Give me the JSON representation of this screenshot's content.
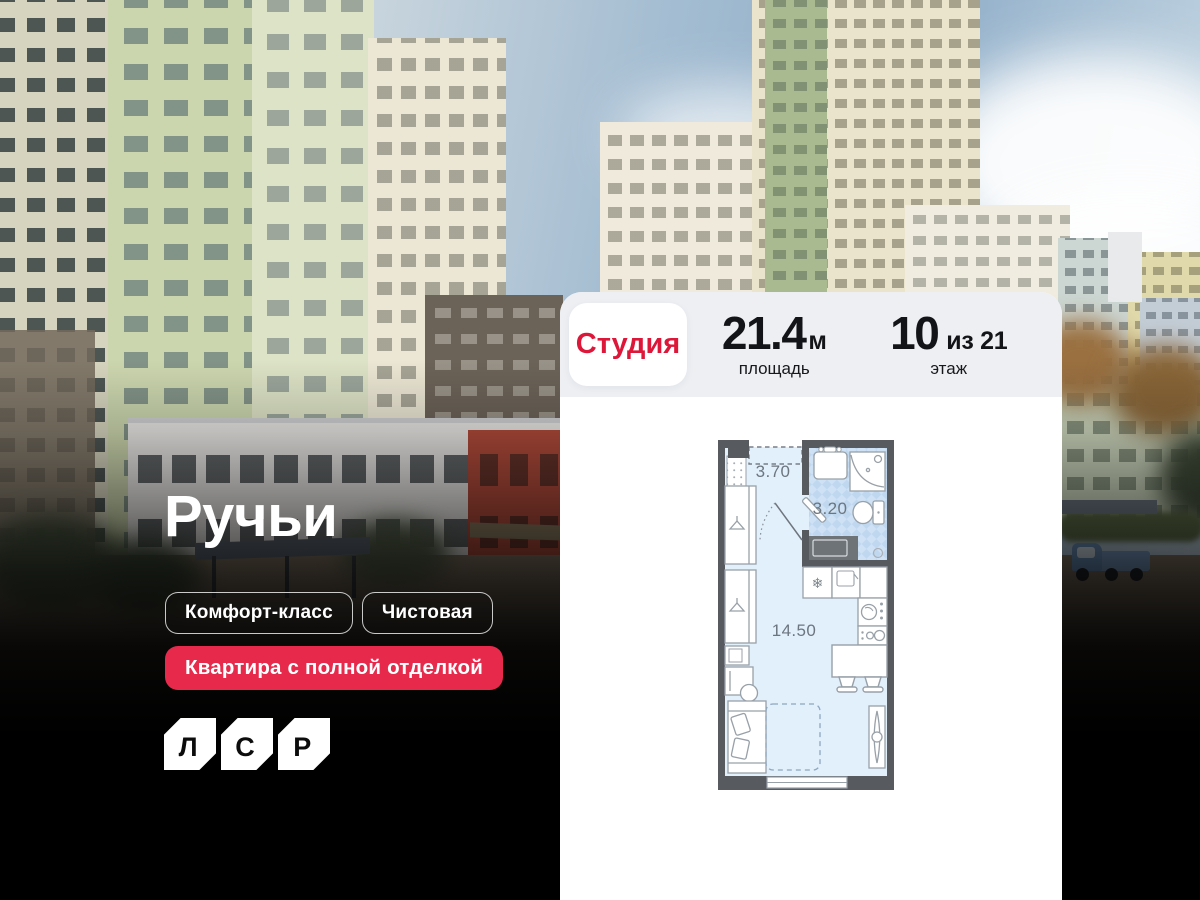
{
  "brand": {
    "logo_letters": [
      "Л",
      "С",
      "Р"
    ],
    "accent_red": "#dd1739",
    "badge_red": "#e72a4c"
  },
  "project": {
    "title": "Ручьи",
    "tags": [
      {
        "label": "Комфорт-класс"
      },
      {
        "label": "Чистовая"
      }
    ],
    "highlight": "Квартира с полной отделкой"
  },
  "card": {
    "type_badge": "Студия",
    "area": {
      "value": "21.4",
      "unit": "м",
      "label": "площадь"
    },
    "floor": {
      "value": "10",
      "suffix": "из 21",
      "label": "этаж"
    }
  },
  "floorplan": {
    "rooms": [
      {
        "name": "прихожая",
        "area": "3.70"
      },
      {
        "name": "санузел",
        "area": "3.20"
      },
      {
        "name": "комната",
        "area": "14.50"
      }
    ]
  }
}
